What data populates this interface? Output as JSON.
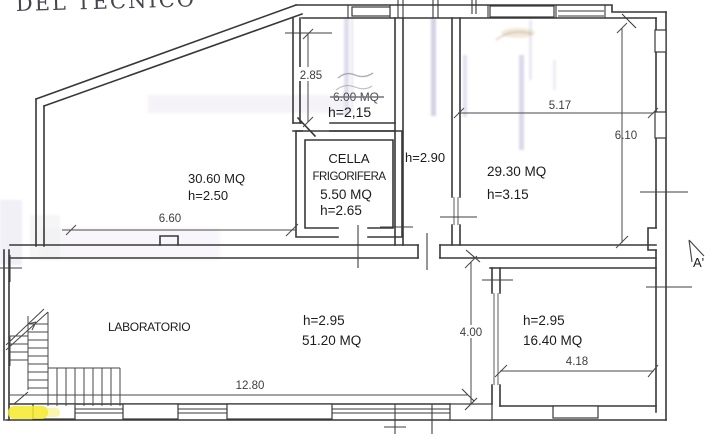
{
  "document": {
    "handwritten_note": "DEL TECNICO"
  },
  "rooms": {
    "room_top_left": {
      "area": "30.60 MQ",
      "height": "h=2.50"
    },
    "room_top_small": {
      "height": "h=2,15",
      "area_struck_out": "6.00 MQ"
    },
    "cella_frigorifera": {
      "name_line1": "CELLA",
      "name_line2": "FRIGORIFERA",
      "area": "5.50 MQ",
      "height": "h=2.65"
    },
    "corridor": {
      "height": "h=2.90"
    },
    "room_top_right": {
      "area": "29.30 MQ",
      "height": "h=3.15"
    },
    "laboratorio": {
      "name": "LABORATORIO",
      "height": "h=2.95",
      "area": "51.20 MQ"
    },
    "room_bottom_right": {
      "height": "h=2.95",
      "area": "16.40 MQ"
    }
  },
  "dimensions": {
    "d_2_85": "2.85",
    "d_6_60": "6.60",
    "d_5_17": "5.17",
    "d_6_10": "6.10",
    "d_12_80": "12.80",
    "d_4_00": "4.00",
    "d_4_18": "4.18"
  },
  "markers": {
    "section_label": "A'"
  },
  "colors": {
    "ink": "#383838",
    "highlighter": "#f4ea2a",
    "whiteout_streak": "#b9b3d6"
  }
}
